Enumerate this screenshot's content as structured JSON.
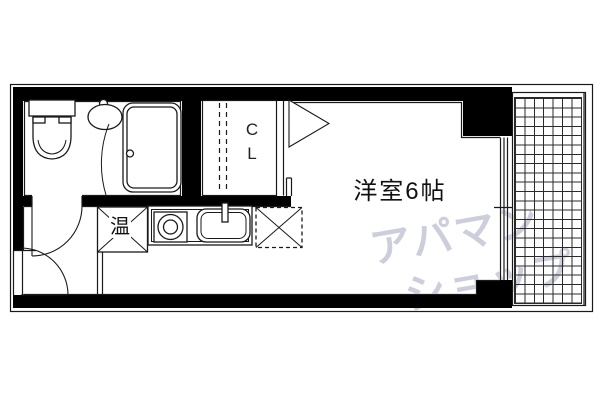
{
  "floorplan": {
    "room_label": "洋室6帖",
    "closet_letters": [
      "C",
      "L"
    ],
    "water_heater_label": "温",
    "icons": {
      "toilet-icon": "tank + bowl outline shape",
      "bathroom-sink-icon": "oval basin with faucet dot",
      "bathtub-icon": "double rounded rectangle with drain dot",
      "bathroom-door-arc": "quarter-circle swing arc",
      "entrance-door-arc": "quarter-circle swing arc",
      "closet-hanger-dashes": "two vertical dashed lines",
      "closet-door-triangle-icon": "right-pointing triangle outline",
      "water-heater-icon": "box with corner diagonals and 温 kanji",
      "stove-icon": "square with concentric burner circles",
      "kitchen-sink-icon": "rounded basin with faucet bar",
      "refrigerator-space-icon": "dashed box with X",
      "balcony-grid": "square tile grid hatch"
    },
    "colors": {
      "wall": "#000000",
      "line": "#1a1a1a",
      "watermark": "#c9cad9",
      "background": "#ffffff"
    }
  },
  "watermark": {
    "line1": "アパマン",
    "line2": "ショップ"
  }
}
